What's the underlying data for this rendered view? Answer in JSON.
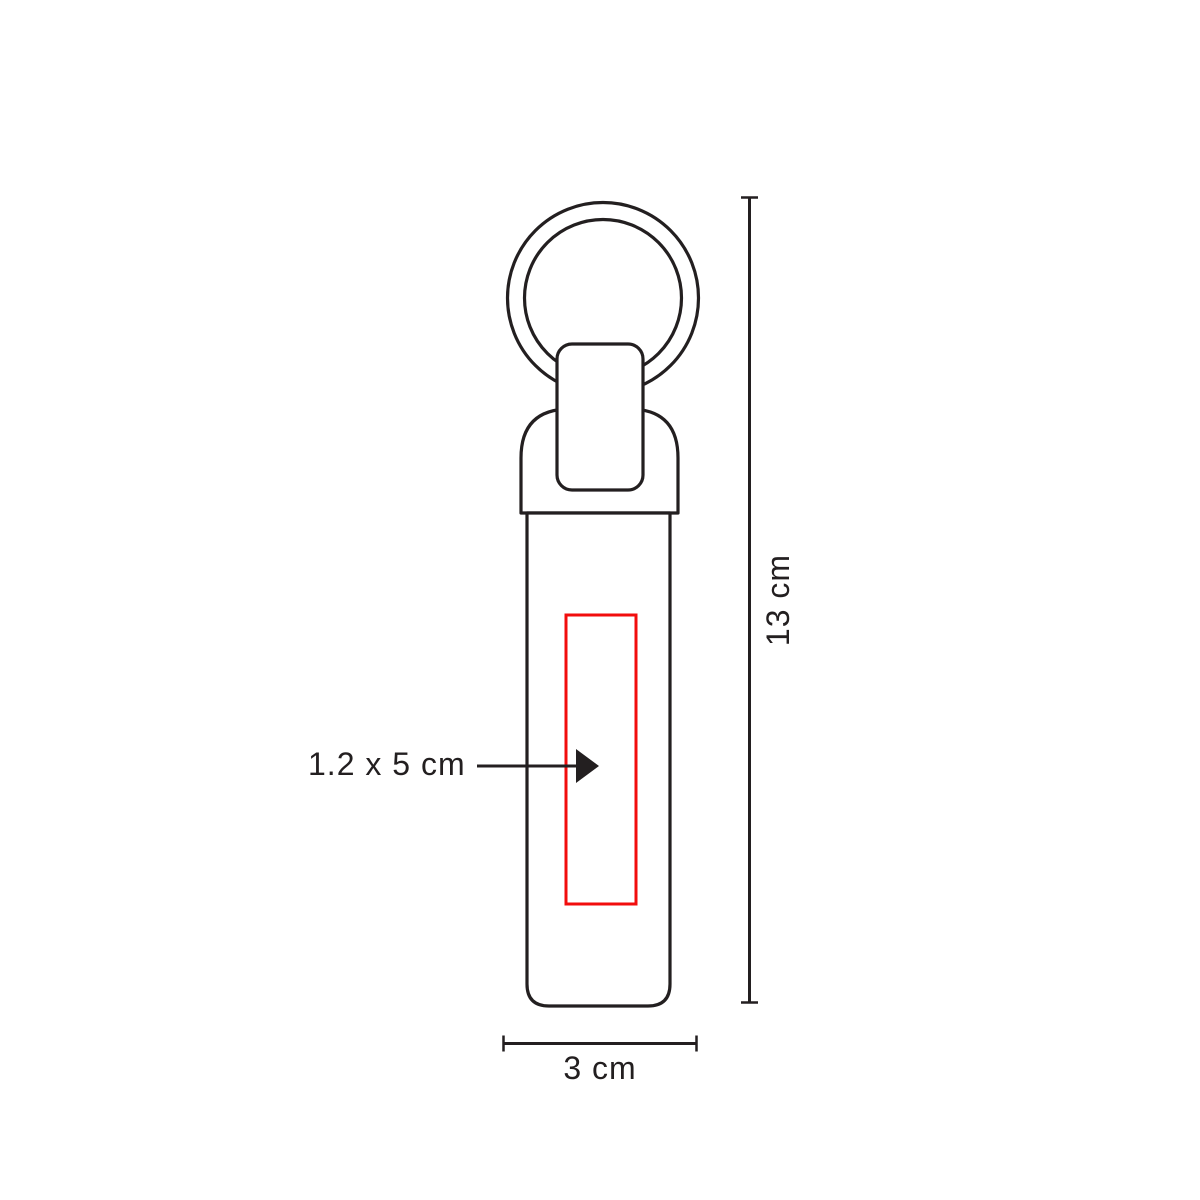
{
  "page": {
    "background": "#ffffff"
  },
  "diagram": {
    "labels": {
      "print_area": "1.2 x 5 cm",
      "height": "13 cm",
      "width": "3 cm"
    },
    "colors": {
      "outline": "#231f20",
      "print_area_stroke": "#f20d0d",
      "dimension_line": "#231f20",
      "text": "#231f20",
      "fill": "#ffffff"
    }
  }
}
